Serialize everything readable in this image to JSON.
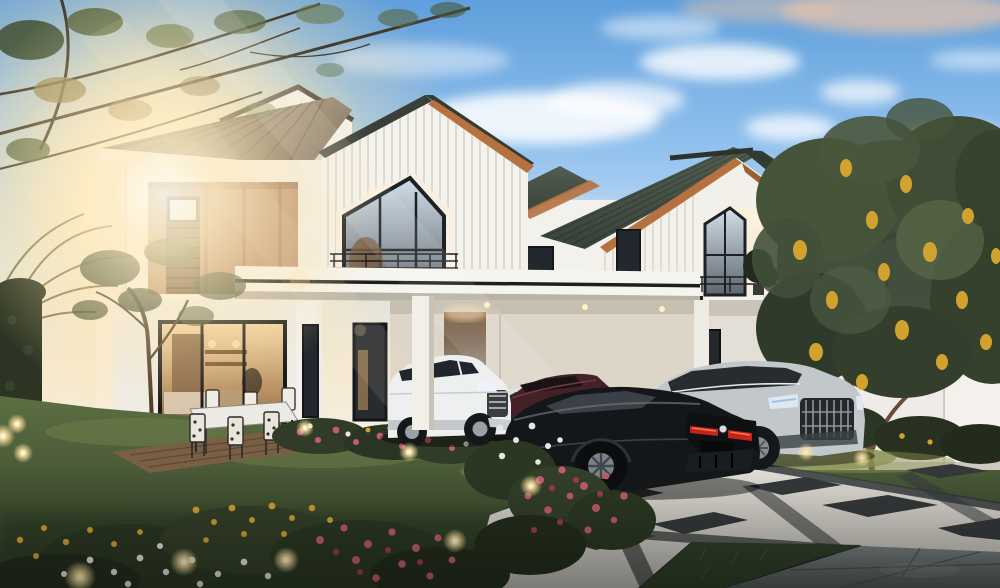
{
  "scene": {
    "alt": "Dusk architectural rendering: two modern white two-storey houses with grey tiled roofs and timber accents, a carport with a white SUV, a black coupe and a silver SUV on a chequered driveway, lawn with flower beds, glowing garden lights, backlit tree on the left with sun flare, flowering tree over a white fence on the right",
    "time_of_day": "dusk"
  },
  "palette": {
    "sky_top": "#5f9fdc",
    "sky_mid": "#93c2ee",
    "sky_low": "#cfe2f4",
    "sky_horizon": "#f3ebdc",
    "sun_core": "#fffdf2",
    "sun_glow": "#ffe9b8",
    "cloud_white": "#ffffff",
    "cloud_peach": "#e6c3ab",
    "wall_white": "#f3f1ec",
    "wall_shadow": "#d9d3c9",
    "wall_warm": "#f8e9cf",
    "roof_main": "#8d7f6d",
    "roof_dark": "#414b40",
    "ridge_dark": "#2c332c",
    "fascia_wood": "#b5713f",
    "wood_accent": "#b98f6f",
    "wood_dark": "#6e5138",
    "door_brown": "#5d4026",
    "glass_dark": "#23282e",
    "glass_sky": "#c8d6e0",
    "interior_warm": "#e8c28c",
    "railing_black": "#1c1c1c",
    "canopy_stripe": "#1f1f1f",
    "grass_light": "#5d6f43",
    "grass_dark": "#2c3a24",
    "grass_lit": "#8a9253",
    "hedge_dark": "#2c3524",
    "foliage_green": "#46543a",
    "foliage_dark": "#2f3a2a",
    "foliage_light": "#5d6d4c",
    "foliage_warm": "#9a8a55",
    "flower_yellow": "#d1a32e",
    "flower_pink": "#c25a70",
    "flower_red": "#a03a50",
    "flower_white": "#e8e6df",
    "trunk_brown": "#6b4a36",
    "deck_wood": "#7a5f45",
    "tile_light": "#dedbd4",
    "tile_dark": "#34383a",
    "stone_gray": "#6b7172",
    "fence_white": "#efece7",
    "car_white": "#eef0f0",
    "car_black": "#141719",
    "car_silver": "#c2c7cb",
    "car_maroon": "#442126",
    "taillight_red": "#c42420",
    "light_glow": "#ffe2a0",
    "light_core": "#fff6d2"
  }
}
